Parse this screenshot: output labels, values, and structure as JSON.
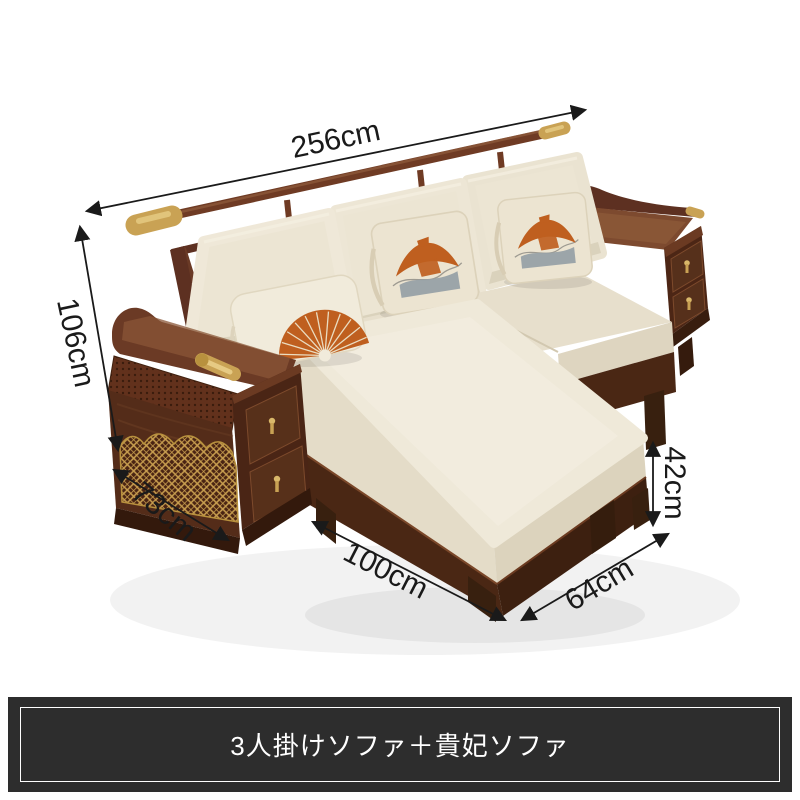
{
  "page": {
    "background_color": "#ffffff",
    "width_px": 800,
    "height_px": 800
  },
  "dimension_annotations": {
    "color": "#1a1a1a",
    "items": [
      {
        "id": "total-width",
        "label": "256cm"
      },
      {
        "id": "total-height",
        "label": "106cm"
      },
      {
        "id": "armrest-cabinet-depth",
        "label": "73cm"
      },
      {
        "id": "chaise-length",
        "label": "100cm"
      },
      {
        "id": "chaise-width",
        "label": "64cm"
      },
      {
        "id": "seat-base-height",
        "label": "42cm"
      }
    ]
  },
  "caption_bar": {
    "text": "3人掛けソファ＋貴妃ソファ",
    "background_color": "#2d2d2d",
    "border_color": "#ffffff",
    "text_color": "#ffffff"
  },
  "illustration": {
    "type": "product-dimension-photo",
    "subject": "wood-l-shaped-sofa-with-chaise",
    "pillows": [
      {
        "name": "fan-pillow"
      },
      {
        "name": "pagoda-pillow"
      },
      {
        "name": "pagoda-pillow"
      }
    ],
    "palette": {
      "wood_dark": "#42220f",
      "wood_mid": "#5d3021",
      "wood_light": "#7d4a2f",
      "cushion_cream": "#ece5d3",
      "cushion_highlight": "#f4efe1",
      "cushion_shadow": "#d6cdb6",
      "brass_gold": "#c9a254",
      "pillow_orange": "#bf5f1f",
      "pillow_gray": "#98a1a7"
    }
  }
}
